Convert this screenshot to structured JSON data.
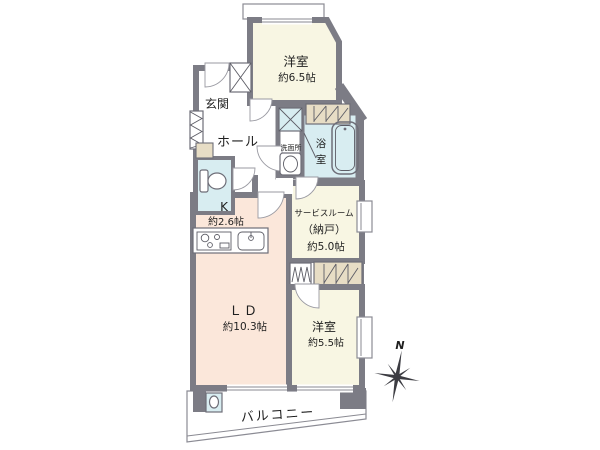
{
  "colors": {
    "wall": "#7c7c85",
    "cream": "#f8f6e3",
    "pink": "#fbe7da",
    "blue": "#d8edf1",
    "beige": "#e7ddc5",
    "outline": "#8b8b94",
    "text": "#1f1f1f"
  },
  "compass": {
    "north_label": "N"
  },
  "rooms": {
    "bedroom_top": {
      "name": "洋室",
      "size": "約6.5帖"
    },
    "entrance": {
      "name": "玄関"
    },
    "hall": {
      "name": "ホール"
    },
    "washroom": {
      "name": "洗面所"
    },
    "bath": {
      "char1": "浴",
      "char2": "室"
    },
    "kitchen": {
      "name": "K",
      "size": "約2.6帖"
    },
    "service_room": {
      "name": "サービスルーム",
      "name2": "（納戸）",
      "size": "約5.0帖"
    },
    "living_dining": {
      "name": "ＬＤ",
      "size": "約10.3帖"
    },
    "bedroom_lower": {
      "name": "洋室",
      "size": "約5.5帖"
    },
    "balcony": {
      "name": "バルコニー"
    }
  },
  "icons": {
    "compass": "compass-rose-icon",
    "bathtub": "bathtub-icon",
    "toilet": "toilet-icon",
    "washbasin": "washbasin-icon",
    "stove": "stove-icon",
    "kitchen_sink": "kitchen-sink-icon",
    "washing_machine": "washing-machine-space-icon",
    "slop_sink": "slop-sink-icon",
    "pipe_shaft": "pipe-shaft-icon",
    "shoe_cabinet": "shoe-cabinet-icon"
  }
}
